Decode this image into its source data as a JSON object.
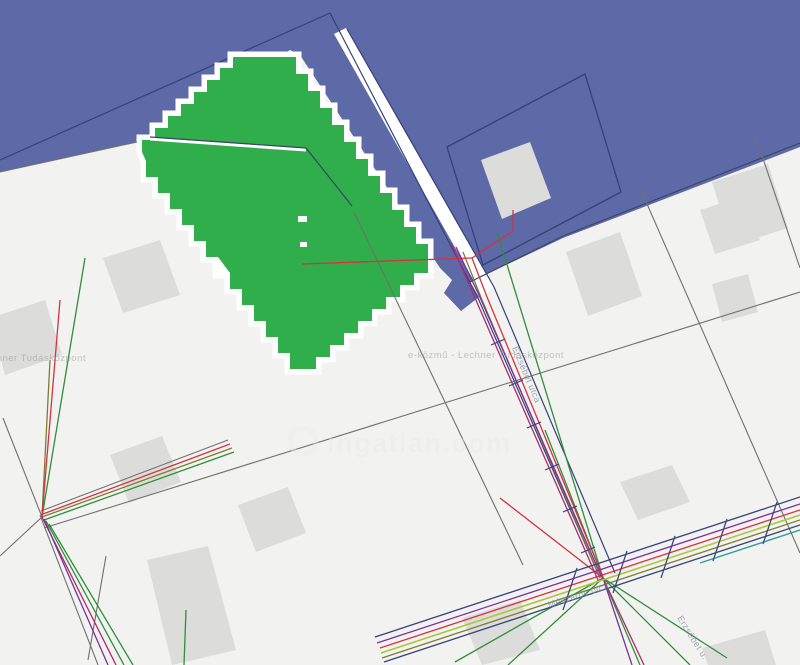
{
  "map": {
    "type": "cadastral-utility-map",
    "colors": {
      "zone_blue": "#5e69a7",
      "parcel_background": "#f2f2f0",
      "highlight_green": "#2fae4b",
      "parcel_casing_white": "#ffffff",
      "building_gray": "#dcdcda",
      "boundary_navy": "#34427c",
      "boundary_dark": "#3a4566",
      "boundary_gray": "#6e726e",
      "utility_red": "#d4333f",
      "utility_magenta": "#b02a6a",
      "utility_purple": "#7a2fa0",
      "utility_olive": "#7d7d34",
      "utility_green": "#2f8f3b",
      "utility_bright_green": "#a8c83a",
      "utility_teal": "#2ba093"
    },
    "tiled_watermark_text": "e-közmű - Lechner Tudásközpont",
    "street_labels": [
      {
        "text": "Erzsébet utca"
      },
      {
        "text": "Mészáros utca"
      },
      {
        "text": "Erzsébet u."
      }
    ],
    "watermark": {
      "icon": "ring-icon",
      "text": "ingatlan.com"
    }
  }
}
